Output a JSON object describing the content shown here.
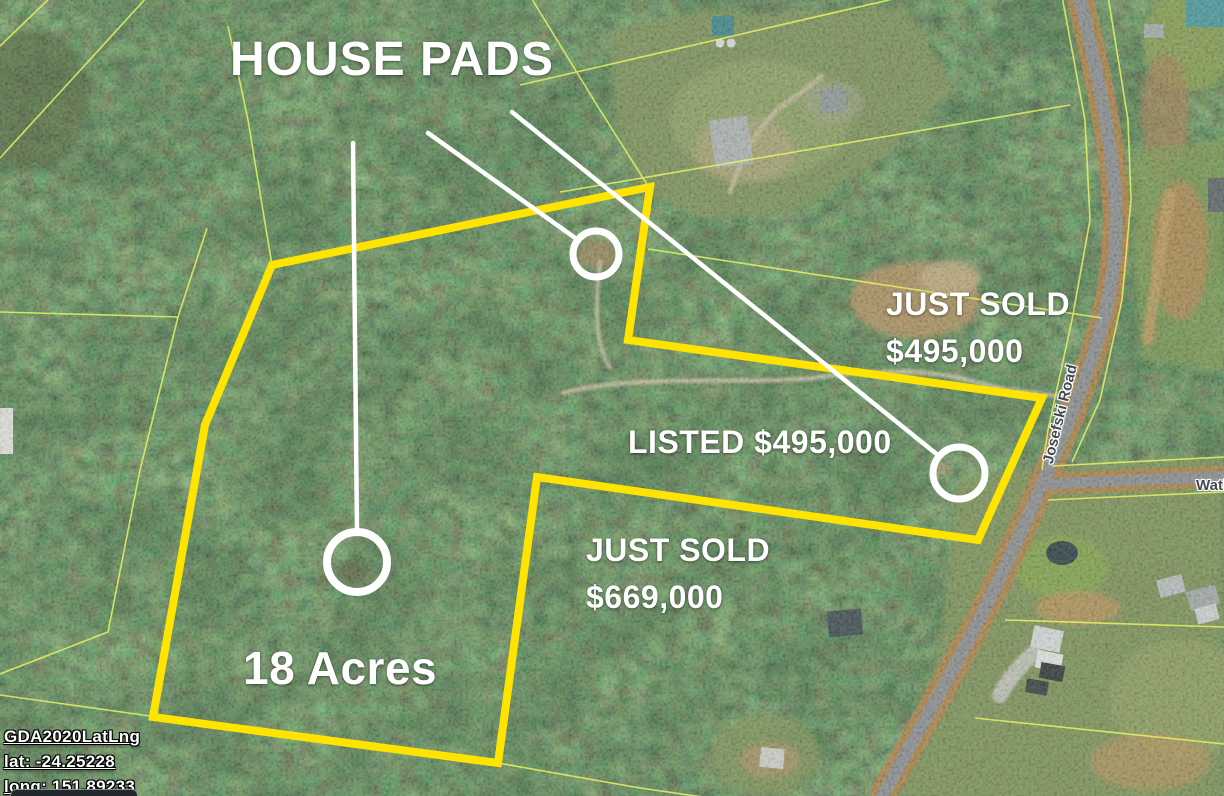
{
  "map": {
    "title": "HOUSE PADS",
    "labels": {
      "sold_ne": {
        "line1": "JUST SOLD",
        "line2": "$495,000"
      },
      "listed": {
        "text": "LISTED $495,000"
      },
      "sold_s": {
        "line1": "JUST SOLD",
        "line2": "$669,000"
      },
      "acreage": {
        "text": "18 Acres"
      }
    },
    "roads": {
      "josefski": "Josefski Road",
      "watkins_partial": "Watki"
    },
    "coordinates": {
      "datum": "GDA2020LatLng",
      "lat": "lat: -24.25228",
      "long": "long: 151.89233"
    },
    "colors": {
      "boundary_highlight": "#ffe400",
      "cadastral_line": "#e6f263",
      "annotation": "#ffffff"
    }
  }
}
